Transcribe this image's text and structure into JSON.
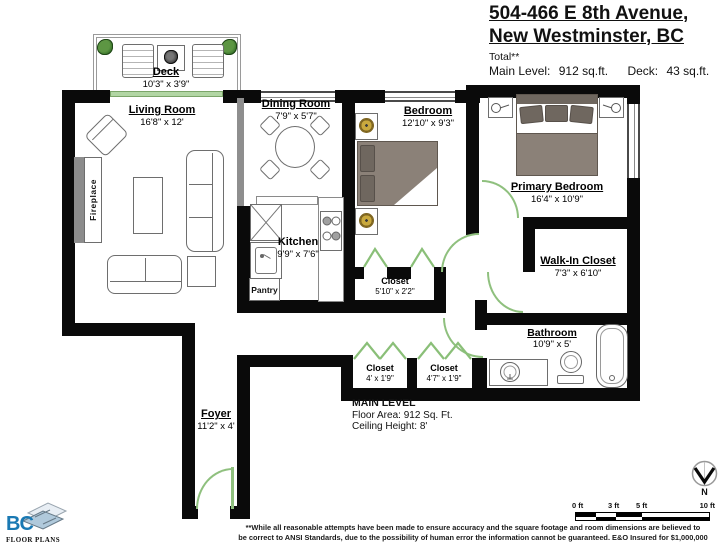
{
  "header": {
    "address_line1": "504-466 E 8th Avenue,",
    "address_line2": "New Westminster, BC",
    "total_note": "Total**",
    "main_level_label": "Main Level:",
    "main_level_value": "912 sq.ft.",
    "deck_label": "Deck:",
    "deck_value": "43 sq.ft."
  },
  "rooms": {
    "deck": {
      "name": "Deck",
      "dims": "10'3\" x 3'9\""
    },
    "living_room": {
      "name": "Living Room",
      "dims": "16'8\" x 12'"
    },
    "dining_room": {
      "name": "Dining Room",
      "dims": "7'9\" x 5'7\""
    },
    "kitchen": {
      "name": "Kitchen",
      "dims": "9'9\" x 7'6\""
    },
    "bedroom": {
      "name": "Bedroom",
      "dims": "12'10\" x 9'3\""
    },
    "primary_bedroom": {
      "name": "Primary Bedroom",
      "dims": "16'4\" x 10'9\""
    },
    "walk_in_closet": {
      "name": "Walk-In Closet",
      "dims": "7'3\" x 6'10\""
    },
    "bedroom_closet": {
      "name": "Closet",
      "dims": "5'10\" x 2'2\""
    },
    "hall_closet_1": {
      "name": "Closet",
      "dims": "4' x 1'9\""
    },
    "hall_closet_2": {
      "name": "Closet",
      "dims": "4'7\" x 1'9\""
    },
    "bathroom": {
      "name": "Bathroom",
      "dims": "10'9\" x 5'"
    },
    "foyer": {
      "name": "Foyer",
      "dims": "11'2\" x 4'"
    }
  },
  "fixtures": {
    "fireplace": "Fireplace",
    "pantry": "Pantry"
  },
  "level_summary": {
    "title": "MAIN LEVEL",
    "floor_area": "Floor Area: 912 Sq. Ft.",
    "ceiling_height": "Ceiling Height: 8'"
  },
  "scale_bar": {
    "tick_0": "0 ft",
    "tick_3": "3 ft",
    "tick_5": "5 ft",
    "tick_10": "10 ft",
    "north_label": "N"
  },
  "disclaimer": {
    "line1": "**While all reasonable attempts have been made to ensure accuracy and the square footage and room dimensions are believed to",
    "line2": "be correct to ANSI Standards, due to the possibility of human error the information cannot be guaranteed. E&O Insured for $1,000,000"
  },
  "logo": {
    "brand": "BC",
    "tagline": "FLOOR PLANS"
  },
  "colors": {
    "wall": "#0a0a0a",
    "door_green": "#8fc07e",
    "bed_gray": "#8b8178",
    "lamp_gold": "#c9a93e",
    "logo_blue": "#1a79b3"
  }
}
